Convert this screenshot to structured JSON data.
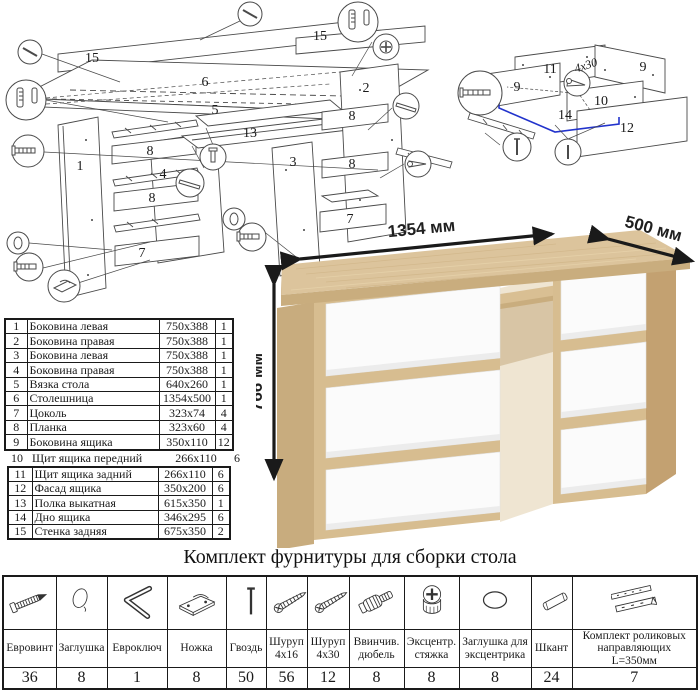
{
  "sheet": {
    "type": "furniture assembly instruction",
    "background": "#ffffff"
  },
  "main_diagram": {
    "description": "exploded view of desk",
    "labels": [
      {
        "text": "15",
        "x": 92,
        "y": 62
      },
      {
        "text": "6",
        "x": 205,
        "y": 86
      },
      {
        "text": "15",
        "x": 320,
        "y": 40
      },
      {
        "text": "2",
        "x": 366,
        "y": 92
      },
      {
        "text": "5",
        "x": 215,
        "y": 114
      },
      {
        "text": "13",
        "x": 250,
        "y": 137
      },
      {
        "text": "3",
        "x": 293,
        "y": 166
      },
      {
        "text": "1",
        "x": 80,
        "y": 170
      },
      {
        "text": "8",
        "x": 150,
        "y": 155
      },
      {
        "text": "4",
        "x": 163,
        "y": 178
      },
      {
        "text": "8",
        "x": 352,
        "y": 120
      },
      {
        "text": "8",
        "x": 152,
        "y": 202
      },
      {
        "text": "8",
        "x": 352,
        "y": 168
      },
      {
        "text": "7",
        "x": 142,
        "y": 257
      },
      {
        "text": "7",
        "x": 350,
        "y": 223
      }
    ],
    "callout_icons": [
      "nail-icon",
      "dowel-plug-icon",
      "euro-screw-icon",
      "cap-icon",
      "foot-icon",
      "slide-rail-icon",
      "bolt-icon",
      "cam-lock-icon",
      "screw-icon"
    ]
  },
  "drawer_diagram": {
    "description": "exploded view of drawer",
    "labels": [
      {
        "text": "11",
        "x": 95,
        "y": 58
      },
      {
        "text": "9",
        "x": 188,
        "y": 56
      },
      {
        "text": "9",
        "x": 62,
        "y": 76
      },
      {
        "text": "10",
        "x": 146,
        "y": 90
      },
      {
        "text": "14",
        "x": 110,
        "y": 104
      },
      {
        "text": "12",
        "x": 172,
        "y": 117
      }
    ],
    "screw_note": "4x30",
    "highlight_color": "#2233cc",
    "callout_icons": [
      "euro-screw-icon",
      "screw-icon",
      "nail-icon"
    ]
  },
  "desk_render": {
    "dimensions": {
      "width": "1354 мм",
      "depth": "500 мм",
      "height": "766 мм"
    },
    "colors": {
      "wood": "#dcc49c",
      "wood_edge": "#c9ad7e",
      "wood_side": "#c3a171",
      "drawer": "#fbfbfb"
    }
  },
  "parts_list": {
    "rows": [
      {
        "num": "1",
        "name": "Боковина левая",
        "size": "750x388",
        "qty": "1"
      },
      {
        "num": "2",
        "name": "Боковина правая",
        "size": "750x388",
        "qty": "1"
      },
      {
        "num": "3",
        "name": "Боковина левая",
        "size": "750x388",
        "qty": "1"
      },
      {
        "num": "4",
        "name": "Боковина правая",
        "size": "750x388",
        "qty": "1"
      },
      {
        "num": "5",
        "name": "Вязка стола",
        "size": "640x260",
        "qty": "1"
      },
      {
        "num": "6",
        "name": "Столешница",
        "size": "1354x500",
        "qty": "1"
      },
      {
        "num": "7",
        "name": "Цоколь",
        "size": "323x74",
        "qty": "4"
      },
      {
        "num": "8",
        "name": "Планка",
        "size": "323x60",
        "qty": "4"
      },
      {
        "num": "9",
        "name": "Боковина ящика",
        "size": "350x110",
        "qty": "12"
      },
      {
        "num": "10",
        "name": "Щит ящика передний",
        "size": "266x110",
        "qty": "6"
      },
      {
        "num": "11",
        "name": "Щит ящика задний",
        "size": "266x110",
        "qty": "6"
      },
      {
        "num": "12",
        "name": "Фасад ящика",
        "size": "350x200",
        "qty": "6"
      },
      {
        "num": "13",
        "name": "Полка выкатная",
        "size": "615x350",
        "qty": "1"
      },
      {
        "num": "14",
        "name": "Дно ящика",
        "size": "346x295",
        "qty": "6"
      },
      {
        "num": "15",
        "name": "Стенка задняя",
        "size": "675x350",
        "qty": "2"
      }
    ]
  },
  "hardware_kit": {
    "title": "Комплект фурнитуры для сборки стола",
    "items": [
      {
        "name": "Евровинт",
        "qty": "36",
        "icon": "euro-screw-icon"
      },
      {
        "name": "Заглушка",
        "qty": "8",
        "icon": "cap-icon"
      },
      {
        "name": "Евроключ",
        "qty": "1",
        "icon": "hex-key-icon"
      },
      {
        "name": "Ножка",
        "qty": "8",
        "icon": "foot-icon"
      },
      {
        "name": "Гвоздь",
        "qty": "50",
        "icon": "nail-icon"
      },
      {
        "name": "Шуруп 4х16",
        "qty": "56",
        "icon": "screw-icon"
      },
      {
        "name": "Шуруп 4х30",
        "qty": "12",
        "icon": "screw-icon"
      },
      {
        "name": "Ввинчив. дюбель",
        "qty": "8",
        "icon": "dowel-screw-icon"
      },
      {
        "name": "Эксцентр. стяжка",
        "qty": "8",
        "icon": "cam-lock-icon"
      },
      {
        "name": "Заглушка для эксцентрика",
        "qty": "8",
        "icon": "cam-cap-icon"
      },
      {
        "name": "Шкант",
        "qty": "24",
        "icon": "wood-dowel-icon"
      },
      {
        "name": "Комплект роликовых направляющих L=350мм",
        "qty": "7",
        "icon": "drawer-slides-icon"
      }
    ]
  }
}
